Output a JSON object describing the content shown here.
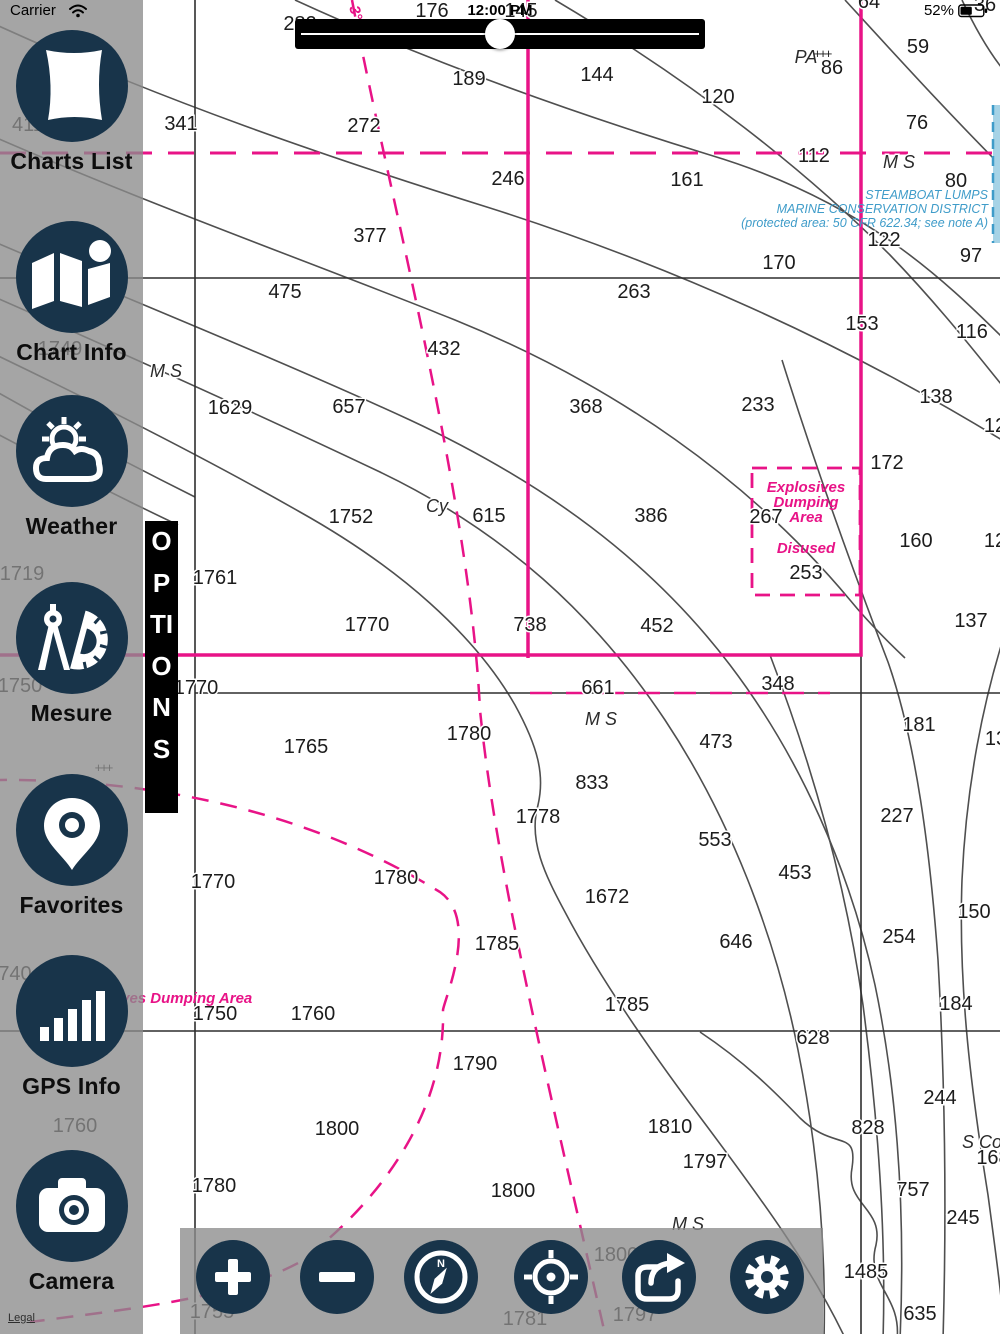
{
  "status_bar": {
    "carrier": "Carrier",
    "time": "12:00 PM",
    "battery_percent": "52%"
  },
  "slider": {
    "value_percent": 50
  },
  "sidebar": {
    "options_label": "OPTIONS",
    "legal_label": "Legal",
    "items": [
      {
        "label": "Charts List",
        "icon": "chart-scroll"
      },
      {
        "label": "Chart Info",
        "icon": "folded-map"
      },
      {
        "label": "Weather",
        "icon": "sun-cloud"
      },
      {
        "label": "Mesure",
        "icon": "compass-protractor"
      },
      {
        "label": "Favorites",
        "icon": "map-pin"
      },
      {
        "label": "GPS Info",
        "icon": "signal-bars"
      },
      {
        "label": "Camera",
        "icon": "camera"
      }
    ]
  },
  "toolbar": {
    "buttons": [
      {
        "name": "zoom-in",
        "icon": "plus"
      },
      {
        "name": "zoom-out",
        "icon": "minus"
      },
      {
        "name": "compass",
        "icon": "compass"
      },
      {
        "name": "locate",
        "icon": "target"
      },
      {
        "name": "share",
        "icon": "share-arrow"
      },
      {
        "name": "settings",
        "icon": "gear"
      }
    ]
  },
  "chart": {
    "colors": {
      "magenta": "#e81387",
      "blue_text": "#3f9cc9",
      "contour": "#4f4f4f",
      "shallow_fill": "#a6d3e6"
    },
    "soundings": [
      {
        "t": "282",
        "x": 300,
        "y": 30
      },
      {
        "t": "176",
        "x": 432,
        "y": 17
      },
      {
        "t": "145",
        "x": 521,
        "y": 17
      },
      {
        "t": "64",
        "x": 869,
        "y": 8
      },
      {
        "t": "36",
        "x": 985,
        "y": 11
      },
      {
        "t": "59",
        "x": 918,
        "y": 53
      },
      {
        "t": "144",
        "x": 597,
        "y": 81
      },
      {
        "t": "189",
        "x": 469,
        "y": 85
      },
      {
        "t": "120",
        "x": 718,
        "y": 103
      },
      {
        "t": "86",
        "x": 832,
        "y": 74
      },
      {
        "t": "411",
        "x": 28,
        "y": 131
      },
      {
        "t": "341",
        "x": 181,
        "y": 130
      },
      {
        "t": "272",
        "x": 364,
        "y": 132
      },
      {
        "t": "76",
        "x": 917,
        "y": 129
      },
      {
        "t": "112",
        "x": 814,
        "y": 162
      },
      {
        "t": "246",
        "x": 508,
        "y": 185
      },
      {
        "t": "161",
        "x": 687,
        "y": 186
      },
      {
        "t": "80",
        "x": 956,
        "y": 187
      },
      {
        "t": "122",
        "x": 884,
        "y": 246
      },
      {
        "t": "97",
        "x": 971,
        "y": 262
      },
      {
        "t": "377",
        "x": 370,
        "y": 242
      },
      {
        "t": "170",
        "x": 779,
        "y": 269
      },
      {
        "t": "263",
        "x": 634,
        "y": 298
      },
      {
        "t": "475",
        "x": 285,
        "y": 298
      },
      {
        "t": "153",
        "x": 862,
        "y": 330
      },
      {
        "t": "116",
        "x": 972,
        "y": 338
      },
      {
        "t": "432",
        "x": 444,
        "y": 355
      },
      {
        "t": "1749",
        "x": 60,
        "y": 355
      },
      {
        "t": "1629",
        "x": 230,
        "y": 414
      },
      {
        "t": "657",
        "x": 349,
        "y": 413
      },
      {
        "t": "368",
        "x": 586,
        "y": 413
      },
      {
        "t": "233",
        "x": 758,
        "y": 411
      },
      {
        "t": "138",
        "x": 936,
        "y": 403
      },
      {
        "t": "172",
        "x": 887,
        "y": 469
      },
      {
        "t": "12",
        "x": 995,
        "y": 432
      },
      {
        "t": "1752",
        "x": 351,
        "y": 523
      },
      {
        "t": "615",
        "x": 489,
        "y": 522
      },
      {
        "t": "386",
        "x": 651,
        "y": 522
      },
      {
        "t": "267",
        "x": 766,
        "y": 523
      },
      {
        "t": "160",
        "x": 916,
        "y": 547
      },
      {
        "t": "12",
        "x": 995,
        "y": 547
      },
      {
        "t": "253",
        "x": 806,
        "y": 579
      },
      {
        "t": "1719",
        "x": 22,
        "y": 580
      },
      {
        "t": "1761",
        "x": 215,
        "y": 584
      },
      {
        "t": "1770",
        "x": 367,
        "y": 631
      },
      {
        "t": "738",
        "x": 530,
        "y": 631
      },
      {
        "t": "452",
        "x": 657,
        "y": 632
      },
      {
        "t": "137",
        "x": 971,
        "y": 627
      },
      {
        "t": "1750",
        "x": 20,
        "y": 692
      },
      {
        "t": "1770",
        "x": 196,
        "y": 694
      },
      {
        "t": "661",
        "x": 598,
        "y": 694
      },
      {
        "t": "348",
        "x": 778,
        "y": 690
      },
      {
        "t": "181",
        "x": 919,
        "y": 731
      },
      {
        "t": "473",
        "x": 716,
        "y": 748
      },
      {
        "t": "13",
        "x": 996,
        "y": 745
      },
      {
        "t": "1765",
        "x": 306,
        "y": 753
      },
      {
        "t": "1780",
        "x": 469,
        "y": 740
      },
      {
        "t": "833",
        "x": 592,
        "y": 789
      },
      {
        "t": "1778",
        "x": 538,
        "y": 823
      },
      {
        "t": "227",
        "x": 897,
        "y": 822
      },
      {
        "t": "1770",
        "x": 213,
        "y": 888
      },
      {
        "t": "1780",
        "x": 396,
        "y": 884
      },
      {
        "t": "553",
        "x": 715,
        "y": 846
      },
      {
        "t": "453",
        "x": 795,
        "y": 879
      },
      {
        "t": "1672",
        "x": 607,
        "y": 903
      },
      {
        "t": "150",
        "x": 974,
        "y": 918
      },
      {
        "t": "646",
        "x": 736,
        "y": 948
      },
      {
        "t": "254",
        "x": 899,
        "y": 943
      },
      {
        "t": "1785",
        "x": 497,
        "y": 950
      },
      {
        "t": "740",
        "x": 15,
        "y": 980
      },
      {
        "t": "1785",
        "x": 627,
        "y": 1011
      },
      {
        "t": "184",
        "x": 956,
        "y": 1010
      },
      {
        "t": "628",
        "x": 813,
        "y": 1044
      },
      {
        "t": "1750",
        "x": 215,
        "y": 1020
      },
      {
        "t": "1760",
        "x": 313,
        "y": 1020
      },
      {
        "t": "1790",
        "x": 475,
        "y": 1070
      },
      {
        "t": "244",
        "x": 940,
        "y": 1104
      },
      {
        "t": "1810",
        "x": 670,
        "y": 1133
      },
      {
        "t": "828",
        "x": 868,
        "y": 1134
      },
      {
        "t": "1800",
        "x": 337,
        "y": 1135
      },
      {
        "t": "1760",
        "x": 75,
        "y": 1132
      },
      {
        "t": "168",
        "x": 993,
        "y": 1164
      },
      {
        "t": "1797",
        "x": 705,
        "y": 1168
      },
      {
        "t": "757",
        "x": 913,
        "y": 1196
      },
      {
        "t": "1780",
        "x": 214,
        "y": 1192
      },
      {
        "t": "1800",
        "x": 513,
        "y": 1197
      },
      {
        "t": "245",
        "x": 963,
        "y": 1224
      },
      {
        "t": "1800",
        "x": 616,
        "y": 1261
      },
      {
        "t": "1485",
        "x": 866,
        "y": 1278
      },
      {
        "t": "1755",
        "x": 212,
        "y": 1318
      },
      {
        "t": "1781",
        "x": 525,
        "y": 1325
      },
      {
        "t": "1797",
        "x": 635,
        "y": 1321
      },
      {
        "t": "635",
        "x": 920,
        "y": 1320
      }
    ],
    "italic_labels": [
      {
        "t": "M S",
        "x": 899,
        "y": 168
      },
      {
        "t": "M S",
        "x": 166,
        "y": 377
      },
      {
        "t": "M S",
        "x": 601,
        "y": 725
      },
      {
        "t": "M S",
        "x": 688,
        "y": 1230
      },
      {
        "t": "Cy",
        "x": 437,
        "y": 512,
        "size": 16
      },
      {
        "t": "PA",
        "x": 806,
        "y": 63,
        "size": 16
      },
      {
        "t": "S Co",
        "x": 982,
        "y": 1148,
        "size": 17
      }
    ],
    "magenta_labels": [
      {
        "t": "Explosives",
        "x": 806,
        "y": 492
      },
      {
        "t": "Dumping",
        "x": 806,
        "y": 507
      },
      {
        "t": "Area",
        "x": 806,
        "y": 522
      },
      {
        "t": "Disused",
        "x": 806,
        "y": 553
      },
      {
        "t": "Explosives Dumping Area",
        "x": 160,
        "y": 1003,
        "size": 17
      },
      {
        "t": "3°",
        "x": 351,
        "y": 14,
        "rotate": 75
      }
    ],
    "blue_labels": [
      {
        "t": "STEAMBOAT LUMPS",
        "x": 988,
        "y": 199
      },
      {
        "t": "MARINE CONSERVATION DISTRICT",
        "x": 988,
        "y": 213
      },
      {
        "t": "(protected area: 50 CFR 622.34; see note A)",
        "x": 988,
        "y": 227
      }
    ],
    "hazard_marks": [
      {
        "t": "+++",
        "x": 822,
        "y": 58
      },
      {
        "t": "+++",
        "x": 103,
        "y": 772
      }
    ]
  }
}
